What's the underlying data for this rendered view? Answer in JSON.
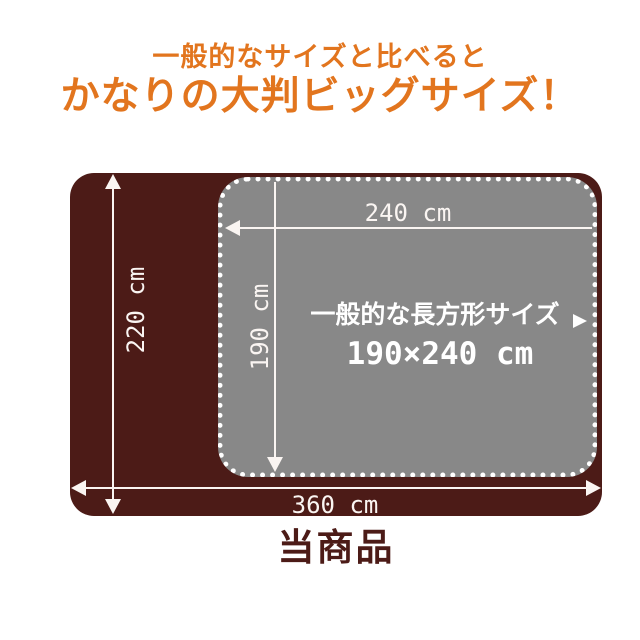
{
  "header": {
    "subtitle": "一般的なサイズと比べると",
    "title": "かなりの大判ビッグサイズ！"
  },
  "diagram": {
    "product": {
      "height_label": "220 cm",
      "width_label": "360 cm"
    },
    "standard": {
      "width_label": "240 cm",
      "height_label": "190 cm",
      "title": "一般的な長方形サイズ",
      "size": "190×240 cm"
    }
  },
  "footer": {
    "caption": "当商品"
  },
  "colors": {
    "accent_orange": "#e2751e",
    "product_brown": "#4c1b17",
    "standard_gray": "#888888",
    "dimension_line": "#faf5f2"
  }
}
